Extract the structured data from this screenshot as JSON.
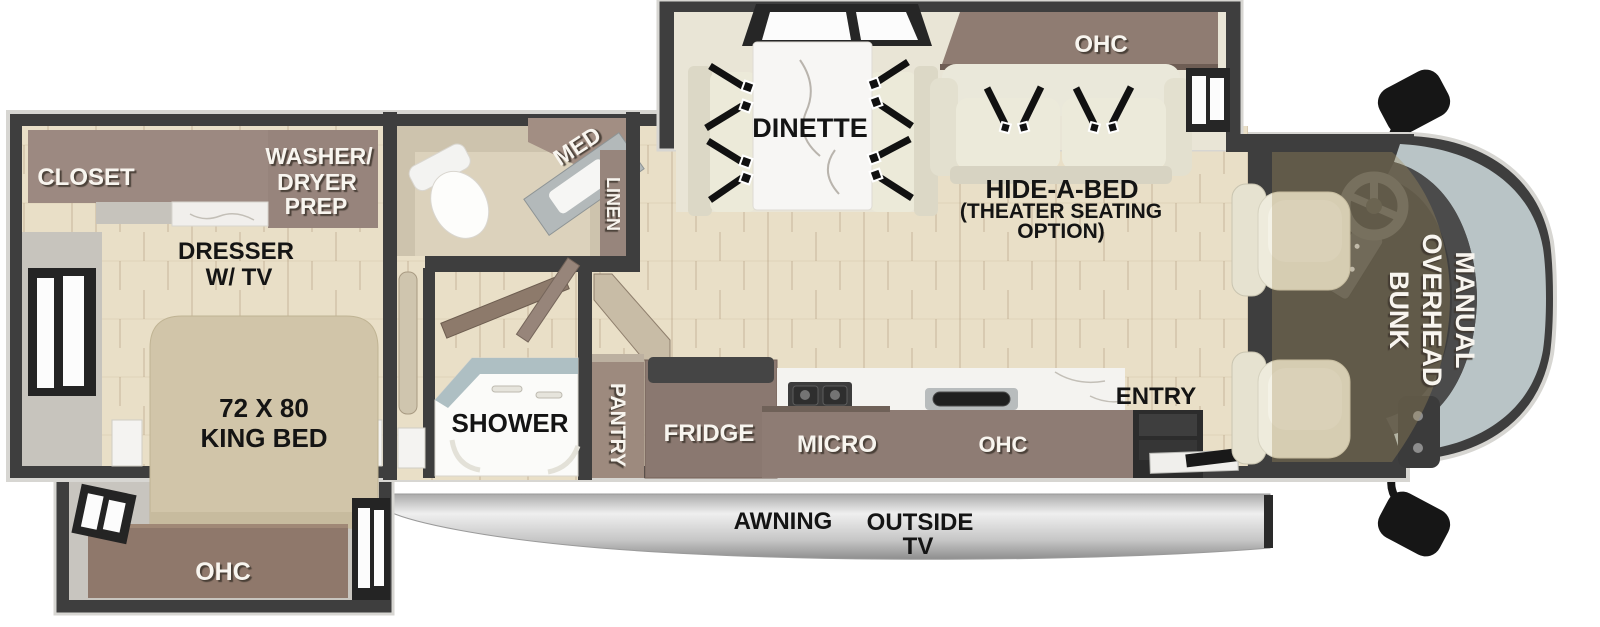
{
  "diagram": {
    "type": "rv-motorhome-floorplan-top-view",
    "colors": {
      "wall": "#3e3e3e",
      "outer_trim": "#d7d6d2",
      "wood_floor": "#e9dfc7",
      "slide_floor": "#e9e5d6",
      "cabinet_brown": "#9c8981",
      "bed_tan": "#d1c5a9",
      "windshield": "#b9c4c6",
      "awning_silver": "#c9c9c9",
      "label_light": "#f8f5ef",
      "label_dark": "#141414"
    },
    "labels": {
      "closet": "CLOSET",
      "washer_dryer": [
        "WASHER/",
        "DRYER",
        "PREP"
      ],
      "dresser": [
        "DRESSER",
        "W/ TV"
      ],
      "king_bed": [
        "72 X 80",
        "KING BED"
      ],
      "bedroom_ohc": "OHC",
      "med": "MED",
      "linen": "LINEN",
      "shower": "SHOWER",
      "pantry": "PANTRY",
      "fridge": "FRIDGE",
      "micro": "MICRO",
      "kitchen_ohc": "OHC",
      "entry": "ENTRY",
      "dinette": "DINETTE",
      "living_ohc": "OHC",
      "hide_a_bed": [
        "HIDE-A-BED",
        "(THEATER SEATING",
        "OPTION)"
      ],
      "overhead_bunk": [
        "MANUAL",
        "OVERHEAD",
        "BUNK"
      ],
      "awning": "AWNING",
      "outside_tv": [
        "OUTSIDE",
        "TV"
      ]
    }
  }
}
